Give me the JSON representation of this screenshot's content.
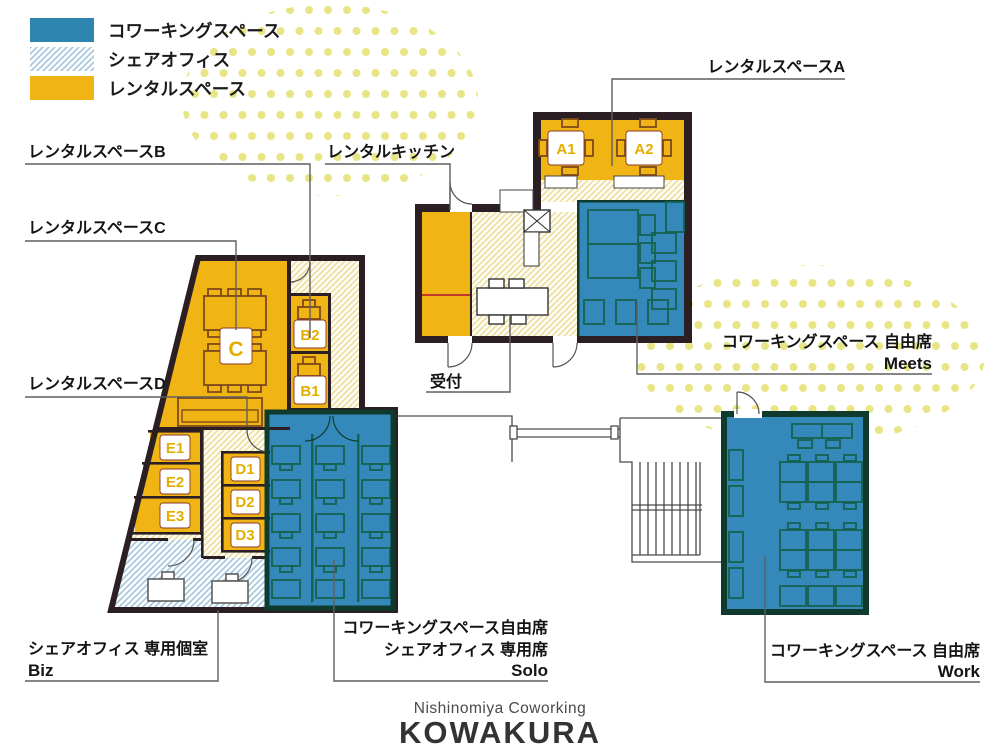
{
  "colors": {
    "coworking_blue": "#3489BA",
    "legend_blue": "#2E86B0",
    "share_hatch_blue": "#A9C8DE",
    "rental_yellow": "#F0B414",
    "wall_dark": "#2B1F24",
    "wall_green": "#0E3B2E",
    "dot_yellow": "#E8E584"
  },
  "legend": {
    "items": [
      {
        "label": "コワーキングスペース",
        "swatch": "solid-blue"
      },
      {
        "label": "シェアオフィス",
        "swatch": "hatch-blue"
      },
      {
        "label": "レンタルスペース",
        "swatch": "solid-yellow"
      }
    ]
  },
  "labels": {
    "rental_a": "レンタルスペースA",
    "rental_b": "レンタルスペースB",
    "rental_c": "レンタルスペースC",
    "rental_d": "レンタルスペースD",
    "rental_kitchen": "レンタルキッチン",
    "reception": "受付",
    "meets_line1": "コワーキングスペース 自由席",
    "meets_line2": "Meets",
    "solo_line1": "コワーキングスペース自由席",
    "solo_line2": "シェアオフィス 専用席",
    "solo_line3": "Solo",
    "biz_line1": "シェアオフィス 専用個室",
    "biz_line2": "Biz",
    "work_line1": "コワーキングスペース 自由席",
    "work_line2": "Work"
  },
  "rooms": {
    "a1": "A1",
    "a2": "A2",
    "b1": "B1",
    "b2": "B2",
    "c": "C",
    "d1": "D1",
    "d2": "D2",
    "d3": "D3",
    "e1": "E1",
    "e2": "E2",
    "e3": "E3"
  },
  "logo": {
    "subtitle": "Nishinomiya Coworking",
    "title": "KOWAKURA"
  }
}
